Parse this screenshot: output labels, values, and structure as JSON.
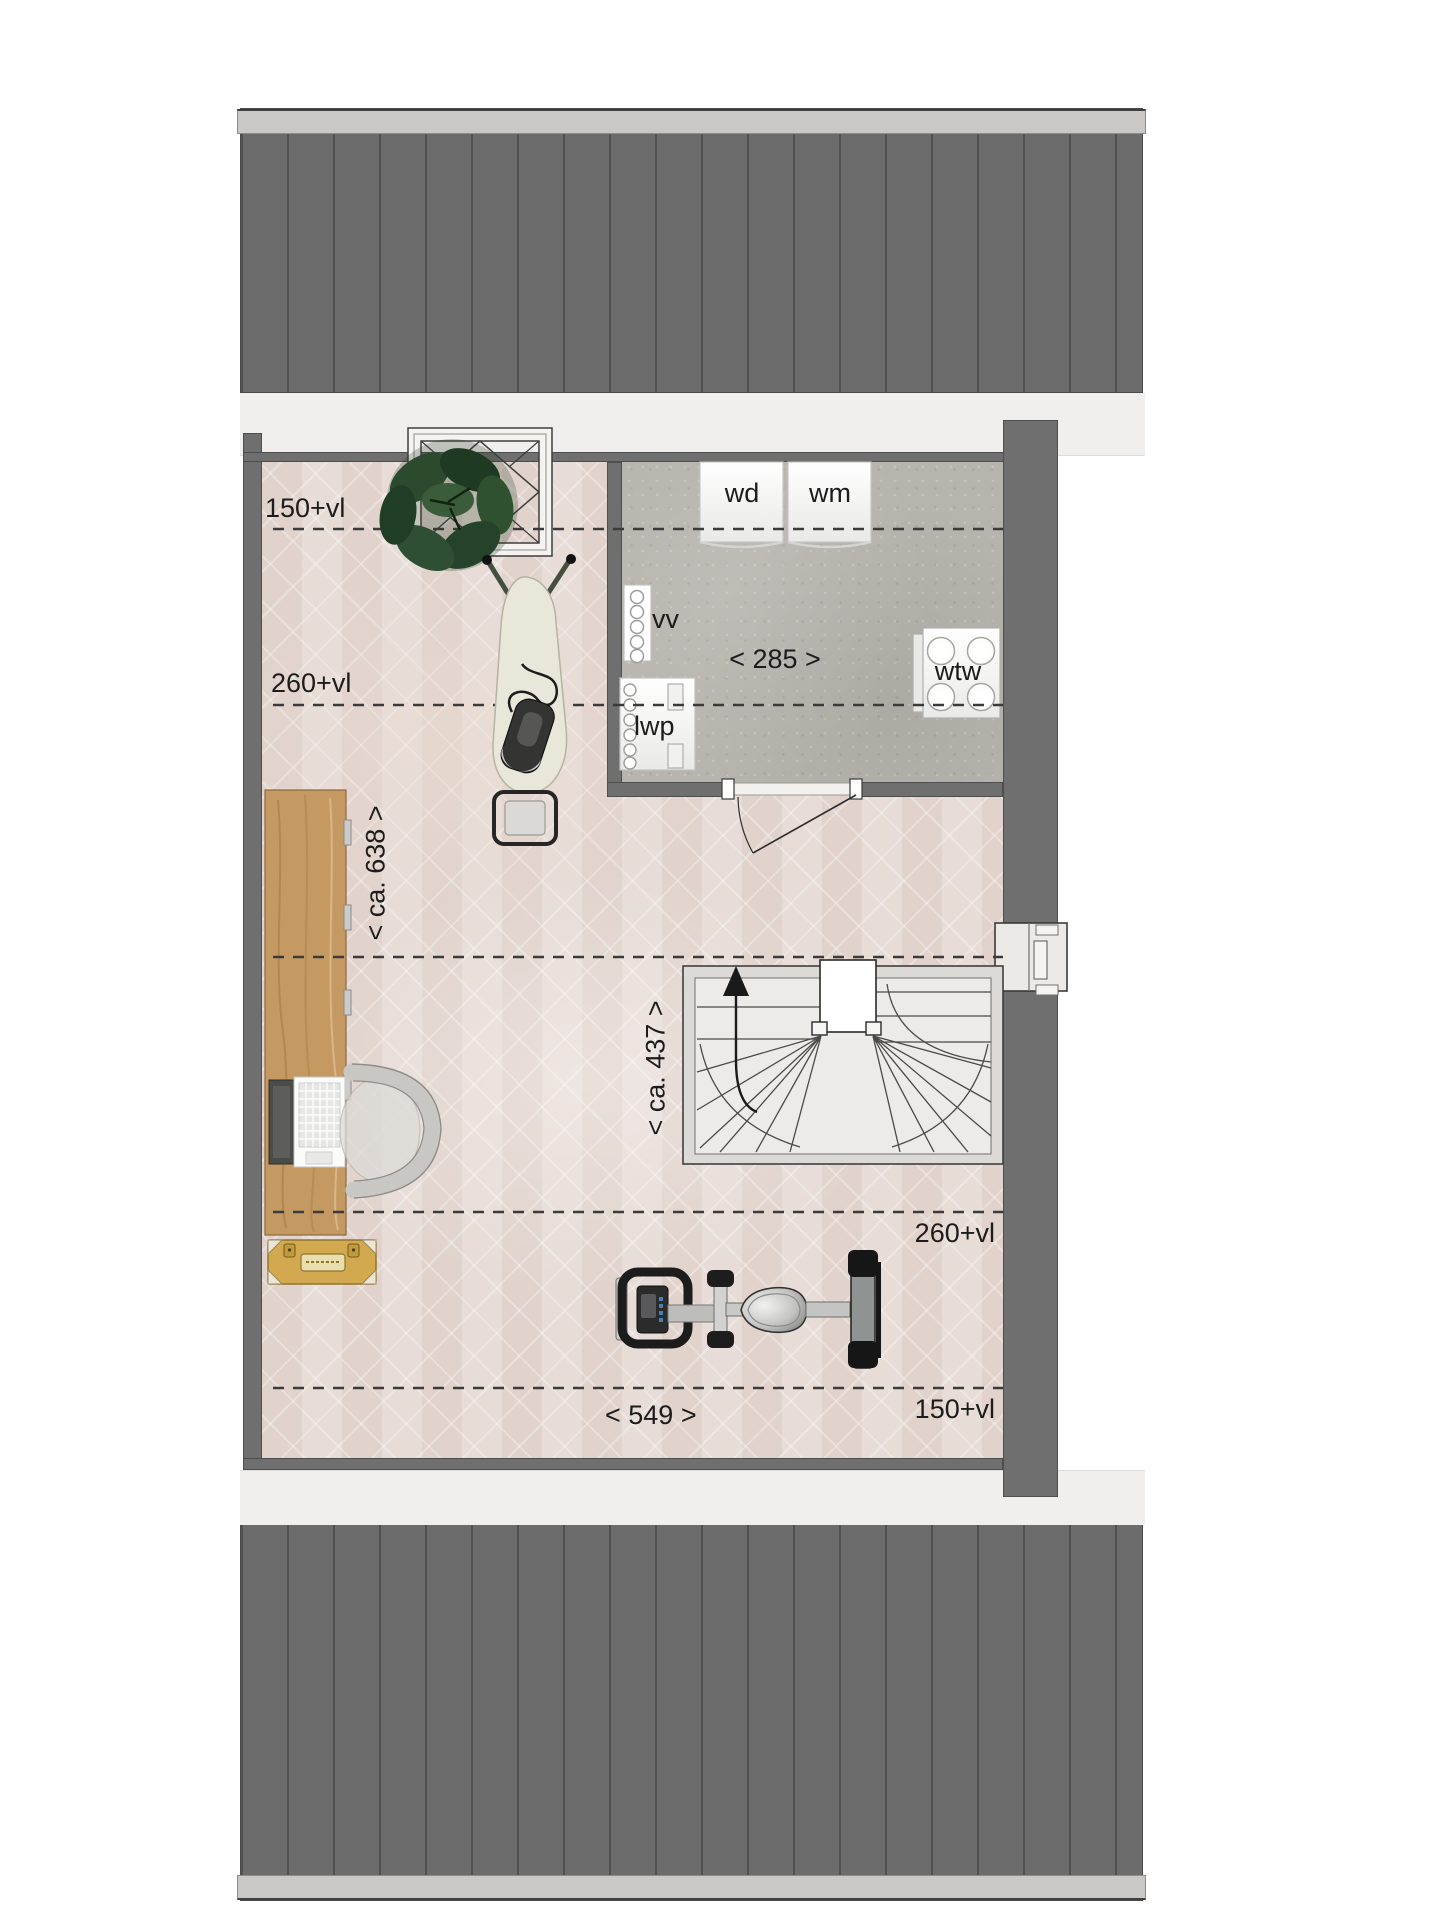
{
  "labels": {
    "dim_150_top": "150+vl",
    "dim_260_top": "260+vl",
    "dim_285": "< 285 >",
    "dim_ca_638": "< ca. 638 >",
    "dim_ca_437": "< ca. 437 >",
    "dim_260_bottom": "260+vl",
    "dim_150_bottom": "150+vl",
    "dim_549": "< 549 >",
    "wd": "wd",
    "wm": "wm",
    "vv": "vv",
    "lwp": "lwp",
    "wtw": "wtw"
  },
  "colors": {
    "roof": "#6c6c6c",
    "roof_ridge": "#c9c8c6",
    "wall": "#6f6f6f",
    "eave": "#f0efed",
    "floor_main": "#e4d8d2",
    "floor_laundry": "#b7b3ad",
    "dimension_line": "#3b3b3b",
    "desk_wood": "#c49a62",
    "chest_yellow": "#d2a94e",
    "plant_green": "#2b4a2e"
  }
}
